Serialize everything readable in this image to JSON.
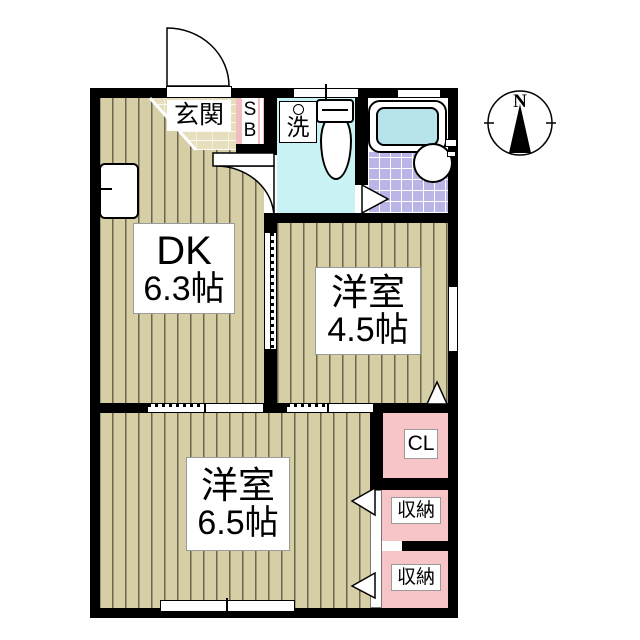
{
  "plan": {
    "rooms": {
      "entrance": {
        "label": "玄関"
      },
      "shoe_box": {
        "letter_top": "S",
        "letter_bottom": "B"
      },
      "washroom": {
        "label": "洗"
      },
      "dk": {
        "name": "DK",
        "size": "6.3帖"
      },
      "western_room_45": {
        "name": "洋室",
        "size": "4.5帖"
      },
      "western_room_65": {
        "name": "洋室",
        "size": "6.5帖"
      },
      "closet": {
        "label": "CL"
      },
      "storage_upper": {
        "label": "収納"
      },
      "storage_lower": {
        "label": "収納"
      }
    },
    "compass": {
      "north": "N"
    },
    "colors": {
      "wall": "#000000",
      "flooring": "#d6cfa6",
      "flooring_stripe": "#6a6650",
      "genkan_tile": "#e6debc",
      "washroom_cyan": "#c9f2f4",
      "bath_tile_purple": "#b9b5e6",
      "bathtub_water": "#b7e3ea",
      "closet_pink": "#f7c5c8",
      "background": "#ffffff"
    }
  }
}
